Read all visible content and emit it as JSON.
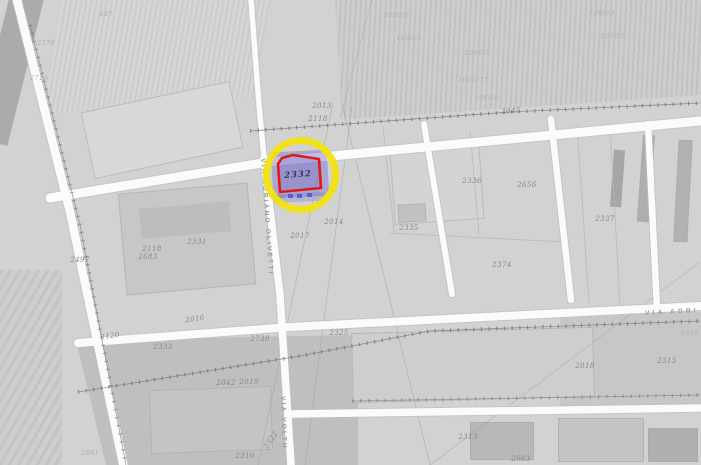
{
  "map": {
    "background_color": "#d2d2d2",
    "road_color": "#fbfbfb",
    "highlight": {
      "parcel_number": "2332",
      "ring_color": "#f1e211",
      "outline_color": "#e01818",
      "fill_color": "rgba(122,112,200,0.45)",
      "marker_blue": "#4656dd"
    },
    "streets": [
      {
        "name": "VIA ADRIANO OLIVETTI",
        "x": 266,
        "y": 158,
        "rotate": 86,
        "spacing": 2.2
      },
      {
        "name": "VIA VOLTU",
        "x": 286,
        "y": 396,
        "rotate": 88,
        "spacing": 2.2
      },
      {
        "name": "VIA ADRI",
        "x": 645,
        "y": 310,
        "rotate": -3,
        "spacing": 3.2
      }
    ],
    "parcel_labels": [
      {
        "t": "2013",
        "x": 322,
        "y": 106
      },
      {
        "t": "2118",
        "x": 318,
        "y": 119
      },
      {
        "t": "2336",
        "x": 472,
        "y": 181
      },
      {
        "t": "2656",
        "x": 527,
        "y": 185
      },
      {
        "t": "2337",
        "x": 605,
        "y": 219
      },
      {
        "t": "2335",
        "x": 409,
        "y": 228
      },
      {
        "t": "2374",
        "x": 502,
        "y": 265
      },
      {
        "t": "2331",
        "x": 197,
        "y": 242
      },
      {
        "t": "2118",
        "x": 152,
        "y": 249
      },
      {
        "t": "2683",
        "x": 148,
        "y": 257
      },
      {
        "t": "2497",
        "x": 80,
        "y": 260
      },
      {
        "t": "2014",
        "x": 334,
        "y": 222
      },
      {
        "t": "2017",
        "x": 300,
        "y": 236
      },
      {
        "t": "2016",
        "x": 195,
        "y": 319,
        "r": -8
      },
      {
        "t": "2120",
        "x": 110,
        "y": 336,
        "r": -8
      },
      {
        "t": "2333",
        "x": 163,
        "y": 347
      },
      {
        "t": "2739",
        "x": 260,
        "y": 339
      },
      {
        "t": "2325",
        "x": 339,
        "y": 333
      },
      {
        "t": "2042",
        "x": 226,
        "y": 383
      },
      {
        "t": "2019",
        "x": 249,
        "y": 382
      },
      {
        "t": "2310",
        "x": 245,
        "y": 456
      },
      {
        "t": "2322",
        "x": 271,
        "y": 440,
        "r": -55
      },
      {
        "t": "2313",
        "x": 468,
        "y": 437
      },
      {
        "t": "2063",
        "x": 521,
        "y": 459
      },
      {
        "t": "2018",
        "x": 585,
        "y": 366
      },
      {
        "t": "2315",
        "x": 667,
        "y": 361
      },
      {
        "t": "2045",
        "x": 511,
        "y": 111,
        "r": -4
      },
      {
        "t": "2370",
        "x": 46,
        "y": 43,
        "c": "faint"
      },
      {
        "t": "2713",
        "x": 39,
        "y": 78,
        "c": "faint"
      },
      {
        "t": "487",
        "x": 106,
        "y": 14,
        "c": "faint"
      },
      {
        "t": "2681",
        "x": 90,
        "y": 453,
        "c": "faint"
      },
      {
        "t": "1016",
        "x": 690,
        "y": 333,
        "c": "faint"
      },
      {
        "t": "1000/8",
        "x": 396,
        "y": 15,
        "c": "faint"
      },
      {
        "t": "1000/5",
        "x": 409,
        "y": 38,
        "c": "faint"
      },
      {
        "t": "1000/7",
        "x": 477,
        "y": 53,
        "c": "faint"
      },
      {
        "t": "1000/77",
        "x": 473,
        "y": 80,
        "c": "faint"
      },
      {
        "t": "1000/6",
        "x": 487,
        "y": 98,
        "c": "faint"
      },
      {
        "t": "1000/3",
        "x": 602,
        "y": 13,
        "c": "faint"
      },
      {
        "t": "1000/9",
        "x": 613,
        "y": 36,
        "c": "faint"
      }
    ]
  }
}
